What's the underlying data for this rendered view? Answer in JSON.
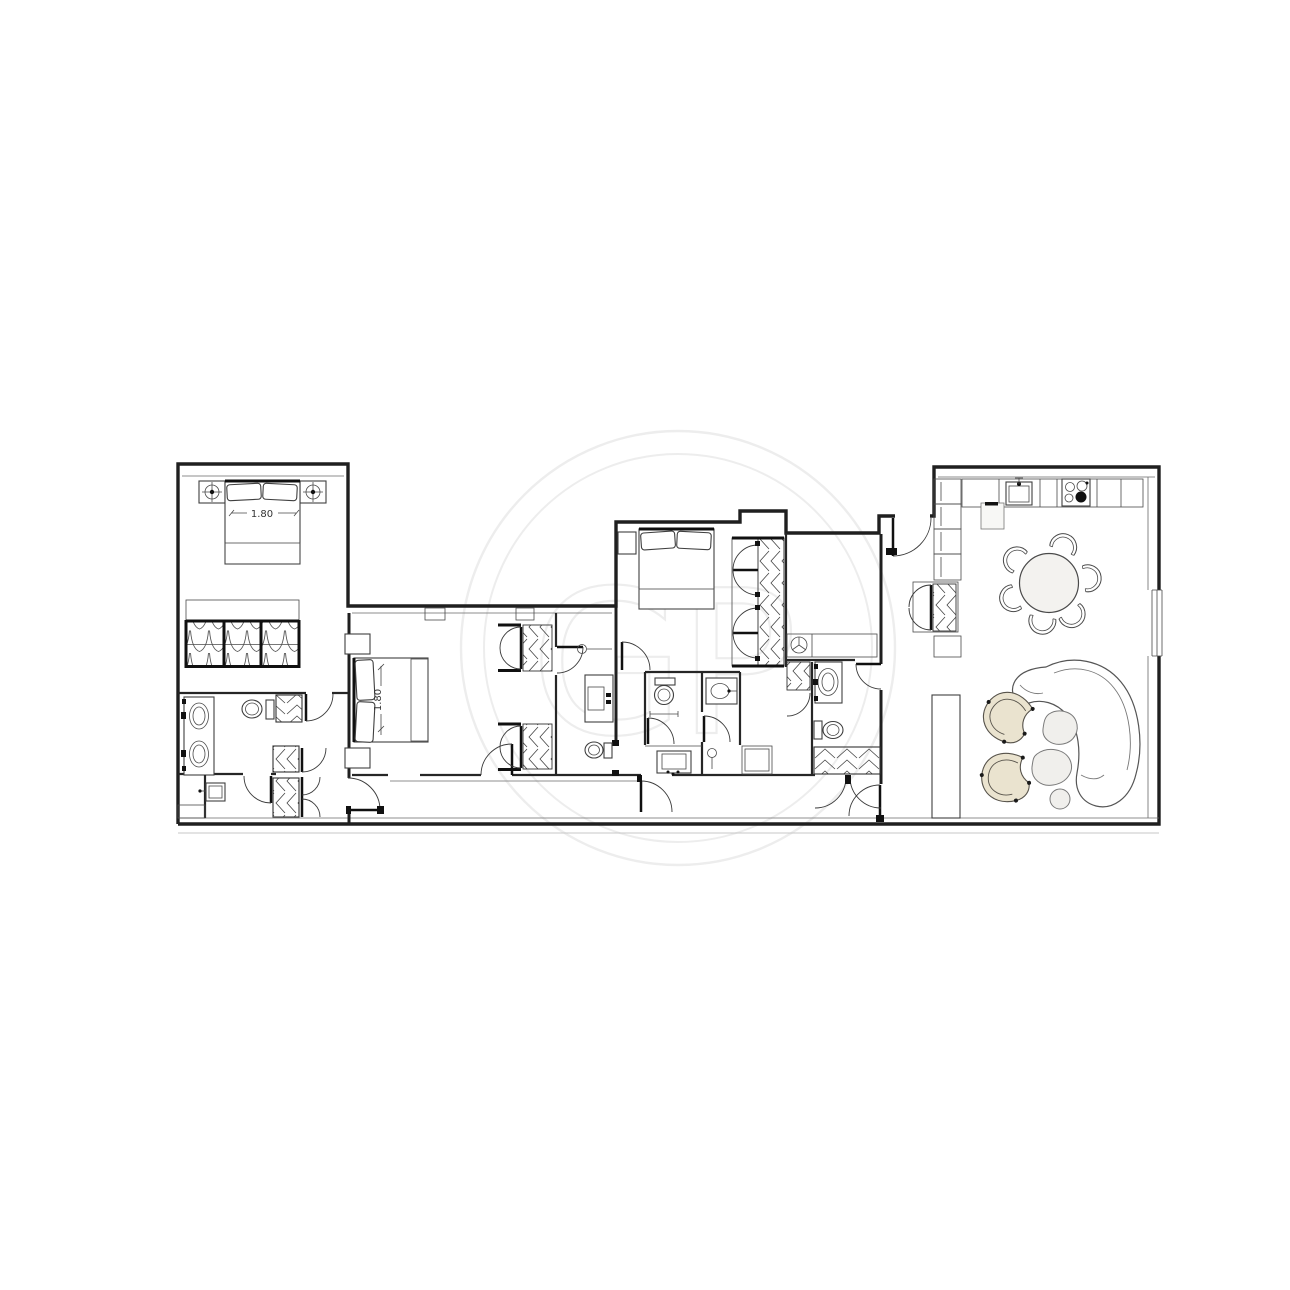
{
  "floorplan": {
    "watermark": {
      "monogram": "GP"
    },
    "dimension_labels": {
      "master_bed_width": "1.80",
      "second_bed_width": "1.80"
    },
    "colors": {
      "light_fill": "#f0efec",
      "beige_fill": "#eae3cf",
      "table_fill": "#f3f2ef",
      "watermark": "#ededed"
    }
  }
}
